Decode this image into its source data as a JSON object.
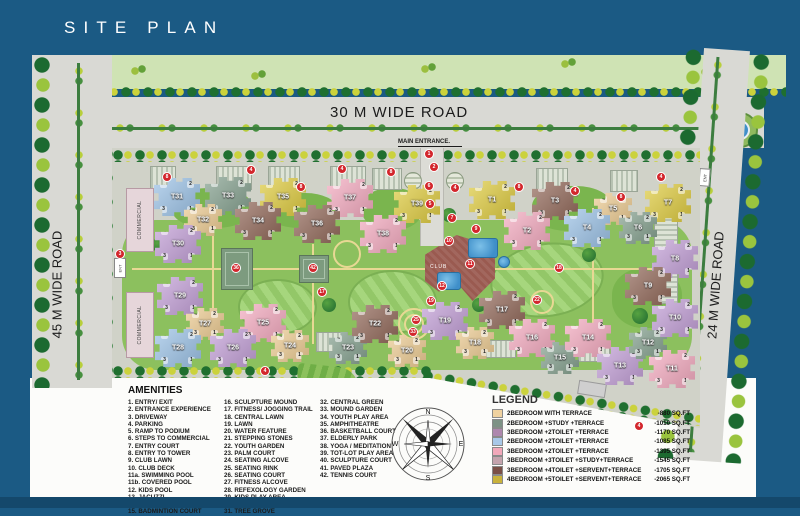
{
  "title": "SITE PLAN",
  "map": {
    "roads": {
      "top": "30 M WIDE ROAD",
      "left": "45 M WIDE ROAD",
      "right": "24 M WIDE ROAD"
    },
    "main_entrance": "MAIN ENTRANCE.",
    "commercial_label": "COMMERCIAL",
    "ent_label": "ENT",
    "club_label": "CLUB",
    "tower_corner_numbers": [
      "4",
      "2",
      "3",
      "1"
    ],
    "tower_colors": {
      "blue": "#9cc2e6",
      "green": "#84a08e",
      "yellow": "#decb40",
      "tan": "#eccb92",
      "pink": "#f3aabf",
      "purple": "#c29fd6",
      "brown": "#92695a"
    },
    "towers": [
      {
        "label": "T31",
        "x": 177,
        "y": 197,
        "type": "blue"
      },
      {
        "label": "T33",
        "x": 228,
        "y": 196,
        "type": "green"
      },
      {
        "label": "T35",
        "x": 283,
        "y": 197,
        "type": "yellow"
      },
      {
        "label": "T37",
        "x": 350,
        "y": 198,
        "type": "pink"
      },
      {
        "label": "T39",
        "x": 417,
        "y": 204,
        "type": "yellow"
      },
      {
        "label": "T1",
        "x": 492,
        "y": 200,
        "type": "yellow"
      },
      {
        "label": "T3",
        "x": 555,
        "y": 201,
        "type": "brown"
      },
      {
        "label": "T5",
        "x": 613,
        "y": 209,
        "type": "tan",
        "s": 1
      },
      {
        "label": "T7",
        "x": 668,
        "y": 203,
        "type": "yellow"
      },
      {
        "label": "T32",
        "x": 203,
        "y": 220,
        "type": "tan",
        "s": 1
      },
      {
        "label": "T34",
        "x": 258,
        "y": 221,
        "type": "brown"
      },
      {
        "label": "T36",
        "x": 317,
        "y": 224,
        "type": "brown"
      },
      {
        "label": "T38",
        "x": 383,
        "y": 234,
        "type": "pink"
      },
      {
        "label": "T2",
        "x": 527,
        "y": 231,
        "type": "pink"
      },
      {
        "label": "T4",
        "x": 587,
        "y": 228,
        "type": "blue"
      },
      {
        "label": "T6",
        "x": 638,
        "y": 228,
        "type": "green",
        "s": 1
      },
      {
        "label": "T8",
        "x": 675,
        "y": 259,
        "type": "purple"
      },
      {
        "label": "T30",
        "x": 178,
        "y": 244,
        "type": "purple"
      },
      {
        "label": "T29",
        "x": 180,
        "y": 296,
        "type": "purple"
      },
      {
        "label": "T27",
        "x": 205,
        "y": 324,
        "type": "tan",
        "s": 1
      },
      {
        "label": "T25",
        "x": 263,
        "y": 323,
        "type": "pink"
      },
      {
        "label": "T28",
        "x": 178,
        "y": 348,
        "type": "blue"
      },
      {
        "label": "T26",
        "x": 233,
        "y": 348,
        "type": "purple"
      },
      {
        "label": "T24",
        "x": 290,
        "y": 346,
        "type": "tan",
        "s": 1
      },
      {
        "label": "T23",
        "x": 348,
        "y": 348,
        "type": "green",
        "s": 1
      },
      {
        "label": "T22",
        "x": 375,
        "y": 324,
        "type": "brown"
      },
      {
        "label": "T20",
        "x": 407,
        "y": 351,
        "type": "tan",
        "s": 1
      },
      {
        "label": "T19",
        "x": 445,
        "y": 321,
        "type": "purple"
      },
      {
        "label": "T18",
        "x": 475,
        "y": 343,
        "type": "tan",
        "s": 1
      },
      {
        "label": "T17",
        "x": 502,
        "y": 310,
        "type": "brown"
      },
      {
        "label": "T16",
        "x": 532,
        "y": 338,
        "type": "pink"
      },
      {
        "label": "T15",
        "x": 560,
        "y": 358,
        "type": "green",
        "s": 1
      },
      {
        "label": "T14",
        "x": 588,
        "y": 338,
        "type": "pink"
      },
      {
        "label": "T13",
        "x": 620,
        "y": 366,
        "type": "purple"
      },
      {
        "label": "T12",
        "x": 648,
        "y": 343,
        "type": "green",
        "s": 1
      },
      {
        "label": "T11",
        "x": 672,
        "y": 369,
        "type": "pink"
      },
      {
        "label": "T10",
        "x": 675,
        "y": 318,
        "type": "purple"
      },
      {
        "label": "T9",
        "x": 648,
        "y": 286,
        "type": "brown"
      }
    ],
    "markers": [
      {
        "n": "1",
        "x": 429,
        "y": 154
      },
      {
        "n": "2",
        "x": 434,
        "y": 167
      },
      {
        "n": "6",
        "x": 429,
        "y": 186
      },
      {
        "n": "5",
        "x": 430,
        "y": 204
      },
      {
        "n": "7",
        "x": 452,
        "y": 218
      },
      {
        "n": "8",
        "x": 167,
        "y": 177
      },
      {
        "n": "4",
        "x": 251,
        "y": 170
      },
      {
        "n": "8",
        "x": 301,
        "y": 187
      },
      {
        "n": "4",
        "x": 342,
        "y": 169
      },
      {
        "n": "8",
        "x": 391,
        "y": 172
      },
      {
        "n": "4",
        "x": 455,
        "y": 188
      },
      {
        "n": "8",
        "x": 519,
        "y": 187
      },
      {
        "n": "4",
        "x": 575,
        "y": 191
      },
      {
        "n": "8",
        "x": 621,
        "y": 197
      },
      {
        "n": "4",
        "x": 661,
        "y": 177
      },
      {
        "n": "3",
        "x": 120,
        "y": 254
      },
      {
        "n": "9",
        "x": 476,
        "y": 229
      },
      {
        "n": "10",
        "x": 449,
        "y": 241
      },
      {
        "n": "11",
        "x": 470,
        "y": 264
      },
      {
        "n": "12",
        "x": 442,
        "y": 286
      },
      {
        "n": "36",
        "x": 236,
        "y": 268
      },
      {
        "n": "42",
        "x": 313,
        "y": 268
      },
      {
        "n": "17",
        "x": 322,
        "y": 292
      },
      {
        "n": "18",
        "x": 559,
        "y": 268
      },
      {
        "n": "19",
        "x": 431,
        "y": 301
      },
      {
        "n": "22",
        "x": 537,
        "y": 300
      },
      {
        "n": "25",
        "x": 416,
        "y": 320
      },
      {
        "n": "33",
        "x": 413,
        "y": 332
      },
      {
        "n": "4",
        "x": 265,
        "y": 371
      },
      {
        "n": "4",
        "x": 639,
        "y": 426
      }
    ]
  },
  "amenities": {
    "title": "AMENITIES",
    "columns": [
      [
        "1. ENTRY/ EXIT",
        "2. ENTRANCE EXPERIENCE",
        "3. DRIVEWAY",
        "4. PARKING",
        "5. RAMP TO PODIUM",
        "6. STEPS TO COMMERCIAL",
        "7. ENTRY COURT",
        "8. ENTRY TO TOWER",
        "9. CLUB LAWN",
        "10. CLUB DECK",
        "11a. SWIMMING POOL",
        "11b. COVERED POOL",
        "12. KIDS POOL",
        "13. JACUZZI",
        "14. BAMBOO GROVE",
        "15. BADMINTION COURT"
      ],
      [
        "16. SCULPTURE MOUND",
        "17. FITNESS/ JOGGING TRAIL",
        "18. CENTRAL LAWN",
        "19. LAWN",
        "20. WATER FEATURE",
        "21. STEPPING STONES",
        "22. YOUTH GARDEN",
        "23. PALM COURT",
        "24. SEATING ALCOVE",
        "25. SEATING RINK",
        "26. SEATING COURT",
        "27. FITNESS ALCOVE",
        "28. REFEXOLOGY GARDEN",
        "29. KIDS PLAY AREA",
        "30. LANDSCAPE MAZE",
        "31. TREE GROVE"
      ],
      [
        "32. CENTRAL GREEN",
        "33. MOUND GARDEN",
        "34. YOUTH PLAY AREA",
        "35. AMPHITHEATRE",
        "36. BASKETBALL COURT",
        "37. ELDERLY PARK",
        "38. YOGA / MEDITATION",
        "39. TOT-LOT PLAY AREA",
        "40. SCULPTURE COURT",
        "41. PAVED PLAZA",
        "42. TENNIS COURT"
      ]
    ]
  },
  "legend": {
    "title": "LEGEND",
    "items": [
      {
        "label": "2BEDROOM WITH TERRACE",
        "area": "-880 SQ.FT",
        "color": "#f0d2a0"
      },
      {
        "label": "2BEDROOM +STUDY +TERRACE",
        "area": "-1010 SQ.FT",
        "color": "#7d9285"
      },
      {
        "label": "3BEDROOM +2TOILET +TERRACE",
        "area": "-1170 SQ.FT",
        "color": "#ad87ad"
      },
      {
        "label": "2BEDROOM +2TOILET +TERRACE",
        "area": "-1085 SQ.FT",
        "color": "#a8c8e8"
      },
      {
        "label": "3BEDROOM +2TOILET +TERRACE",
        "area": "-1395 SQ.FT",
        "color": "#f2a8ba"
      },
      {
        "label": "3BEDROOM +3TOILET +STUDY+TERRACE",
        "area": "-1545 SQ.FT",
        "color": "#c4a3ad"
      },
      {
        "label": "3BEDROOM +4TOILET +SERVENT+TERRACE",
        "area": "-1705 SQ.FT",
        "color": "#7a4f46"
      },
      {
        "label": "4BEDROOM +5TOILET +SERVENT+TERRACE",
        "area": "-2065 SQ.FT",
        "color": "#c9b23b"
      }
    ]
  },
  "compass": {
    "points": [
      "N",
      "E",
      "S",
      "W"
    ]
  }
}
